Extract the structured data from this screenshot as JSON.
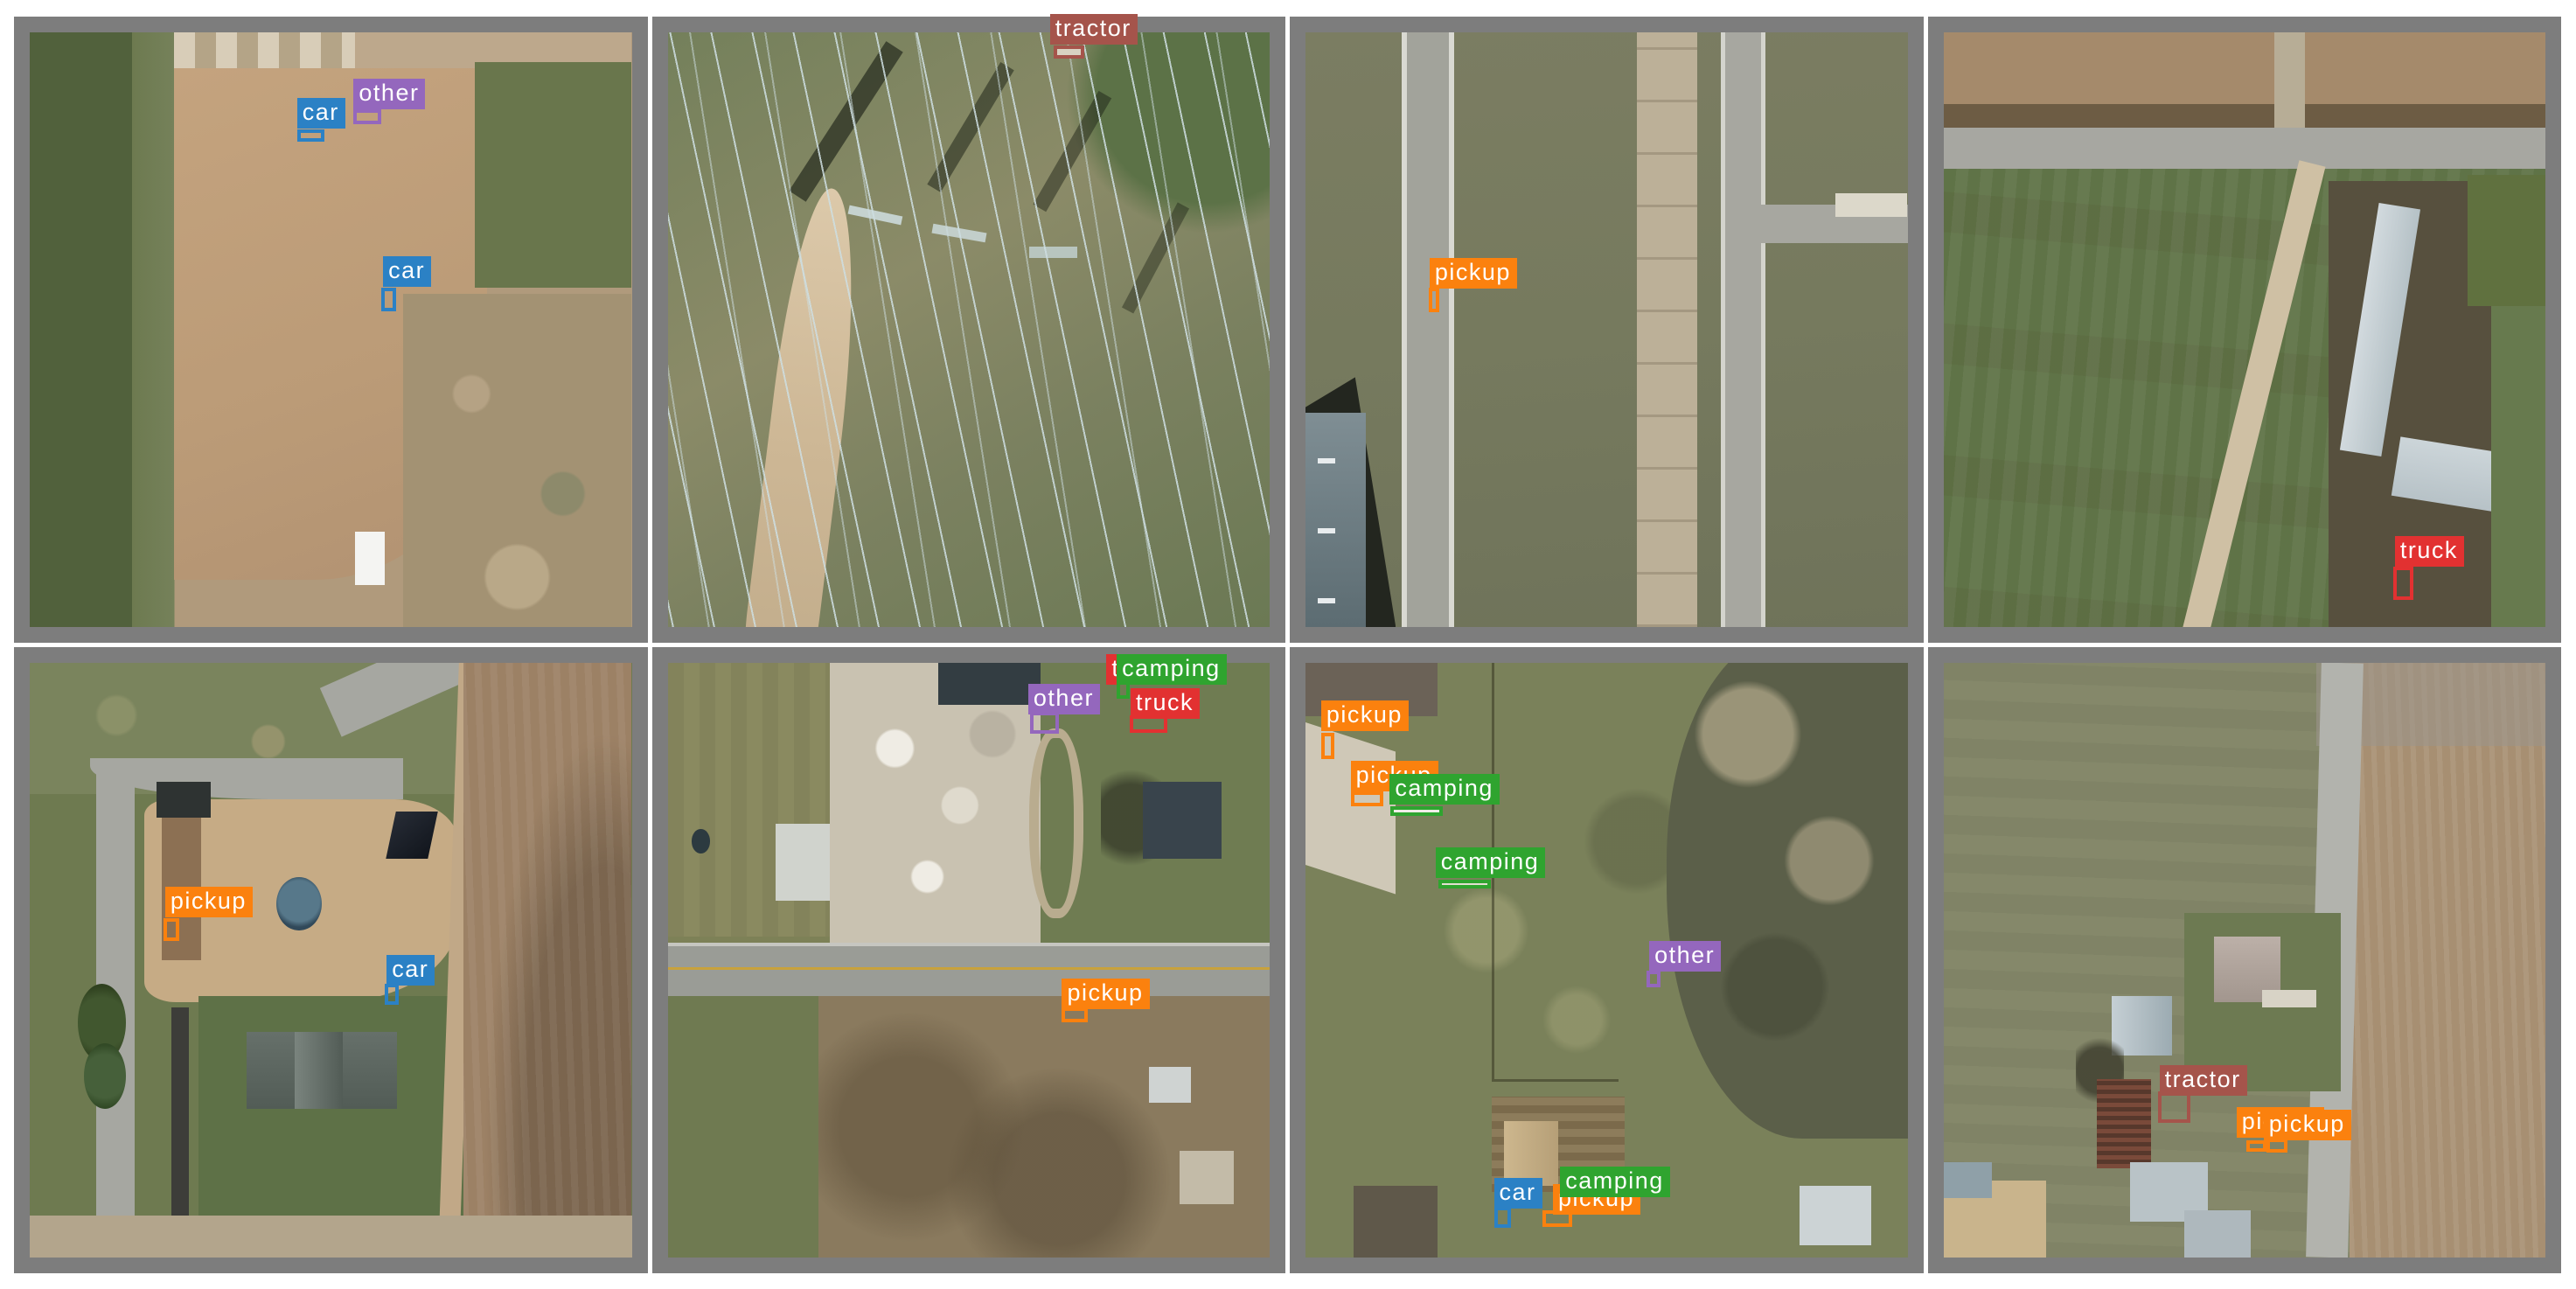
{
  "page": {
    "background": "#ffffff",
    "frame_color": "#7d7d7d",
    "description": "2x4 grid of annotated aerial image tiles with object-detection labels"
  },
  "classes": {
    "car": "#2b81c5",
    "pickup": "#fb810e",
    "truck": "#e23131",
    "camping": "#2fa42f",
    "other": "#9467bd",
    "tractor": "#a5544b"
  },
  "tiles": [
    {
      "annotations": [
        {
          "label": "car",
          "cls": "car",
          "chip": {
            "l": 44.4,
            "t": 11.0
          },
          "box": {
            "l": 44.4,
            "t": 16.3,
            "w": 4.6,
            "h": 2.1
          }
        },
        {
          "label": "other",
          "cls": "other",
          "chip": {
            "l": 53.8,
            "t": 7.8,
            "z": 4
          },
          "box": {
            "l": 53.8,
            "t": 12.9,
            "w": 4.6,
            "h": 2.6
          }
        },
        {
          "label": "car",
          "cls": "car",
          "chip": {
            "l": 58.7,
            "t": 37.6
          },
          "box": {
            "l": 58.4,
            "t": 42.9,
            "w": 2.5,
            "h": 4.0
          }
        }
      ]
    },
    {
      "annotations": [
        {
          "label": "tractor",
          "cls": "tractor",
          "chip": {
            "l": 63.5,
            "t": -3.1
          },
          "box": {
            "l": 64.1,
            "t": 2.2,
            "w": 5.1,
            "h": 2.2,
            "fill": "#d8d2c2"
          }
        }
      ]
    },
    {
      "annotations": [
        {
          "label": "pickup",
          "cls": "pickup",
          "chip": {
            "l": 20.6,
            "t": 37.9
          },
          "box": {
            "l": 20.5,
            "t": 43.0,
            "w": 1.7,
            "h": 4.1
          }
        }
      ]
    },
    {
      "annotations": [
        {
          "label": "truck",
          "cls": "truck",
          "chip": {
            "l": 75.0,
            "t": 84.7
          },
          "box": {
            "l": 74.7,
            "t": 89.9,
            "w": 3.3,
            "h": 5.6
          }
        }
      ]
    },
    {
      "annotations": [
        {
          "label": "pickup",
          "cls": "pickup",
          "chip": {
            "l": 22.5,
            "t": 37.7
          },
          "box": {
            "l": 22.2,
            "t": 42.9,
            "w": 2.7,
            "h": 3.8
          }
        },
        {
          "label": "car",
          "cls": "car",
          "chip": {
            "l": 59.3,
            "t": 49.1
          },
          "box": {
            "l": 59.0,
            "t": 53.9,
            "w": 2.3,
            "h": 3.6
          }
        }
      ]
    },
    {
      "annotations": [
        {
          "label": "truck",
          "cls": "truck",
          "chip": {
            "l": 72.9,
            "t": -1.5,
            "z": 3
          }
        },
        {
          "label": "camping",
          "cls": "camping",
          "chip": {
            "l": 74.6,
            "t": -1.5,
            "z": 4
          },
          "box": {
            "l": 74.6,
            "t": 2.2,
            "w": 2.2,
            "h": 3.9
          }
        },
        {
          "label": "other",
          "cls": "other",
          "chip": {
            "l": 59.9,
            "t": 3.5
          },
          "box": {
            "l": 60.2,
            "t": 8.3,
            "w": 4.8,
            "h": 3.6
          }
        },
        {
          "label": "truck",
          "cls": "truck",
          "chip": {
            "l": 76.9,
            "t": 4.2
          },
          "box": {
            "l": 76.8,
            "t": 8.8,
            "w": 6.2,
            "h": 2.9
          }
        },
        {
          "label": "pickup",
          "cls": "pickup",
          "chip": {
            "l": 65.5,
            "t": 53.1
          },
          "box": {
            "l": 65.5,
            "t": 58.0,
            "w": 4.3,
            "h": 2.5
          }
        }
      ]
    },
    {
      "annotations": [
        {
          "label": "pickup",
          "cls": "pickup",
          "chip": {
            "l": 2.6,
            "t": 6.3
          },
          "box": {
            "l": 2.6,
            "t": 11.7,
            "w": 2.2,
            "h": 4.5
          }
        },
        {
          "label": "pickup",
          "cls": "pickup",
          "chip": {
            "l": 7.5,
            "t": 16.4
          },
          "box": {
            "l": 7.5,
            "t": 21.6,
            "w": 5.5,
            "h": 2.5
          }
        },
        {
          "label": "camping",
          "cls": "camping",
          "chip": {
            "l": 14.0,
            "t": 18.7,
            "z": 4
          },
          "box": {
            "l": 14.1,
            "t": 24.1,
            "w": 8.7,
            "h": 1.6,
            "fill": "#efede6"
          }
        },
        {
          "label": "camping",
          "cls": "camping",
          "chip": {
            "l": 21.6,
            "t": 31.1
          },
          "box": {
            "l": 22.1,
            "t": 36.4,
            "w": 8.7,
            "h": 1.6,
            "fill": "#e3dfd2"
          }
        },
        {
          "label": "other",
          "cls": "other",
          "chip": {
            "l": 57.1,
            "t": 46.7
          },
          "box": {
            "l": 56.7,
            "t": 51.8,
            "w": 2.2,
            "h": 2.8
          }
        },
        {
          "label": "car",
          "cls": "car",
          "chip": {
            "l": 31.3,
            "t": 86.6
          },
          "box": {
            "l": 31.3,
            "t": 91.4,
            "w": 2.9,
            "h": 3.6
          }
        },
        {
          "label": "pickup",
          "cls": "pickup",
          "chip": {
            "l": 41.1,
            "t": 87.6,
            "z": 3
          },
          "box": {
            "l": 39.4,
            "t": 92.0,
            "w": 4.9,
            "h": 2.9
          }
        },
        {
          "label": "camping",
          "cls": "camping",
          "chip": {
            "l": 42.3,
            "t": 84.7,
            "z": 4
          },
          "box": {
            "l": 43.0,
            "t": 89.8,
            "w": 3.5,
            "h": 1.5,
            "fill": "#e6e3d8"
          }
        }
      ]
    },
    {
      "annotations": [
        {
          "label": "tractor",
          "cls": "tractor",
          "chip": {
            "l": 35.9,
            "t": 67.7
          },
          "box": {
            "l": 35.6,
            "t": 72.1,
            "w": 5.4,
            "h": 5.3
          }
        },
        {
          "label": "pickup",
          "cls": "pickup",
          "chip": {
            "l": 48.7,
            "t": 74.7,
            "z": 3
          },
          "box": {
            "l": 50.3,
            "t": 80.3,
            "w": 3.3,
            "h": 1.9
          }
        },
        {
          "label": "pickup",
          "cls": "pickup",
          "chip": {
            "l": 53.2,
            "t": 75.1,
            "z": 4
          },
          "box": {
            "l": 53.6,
            "t": 80.0,
            "w": 3.5,
            "h": 2.3
          }
        }
      ]
    }
  ]
}
